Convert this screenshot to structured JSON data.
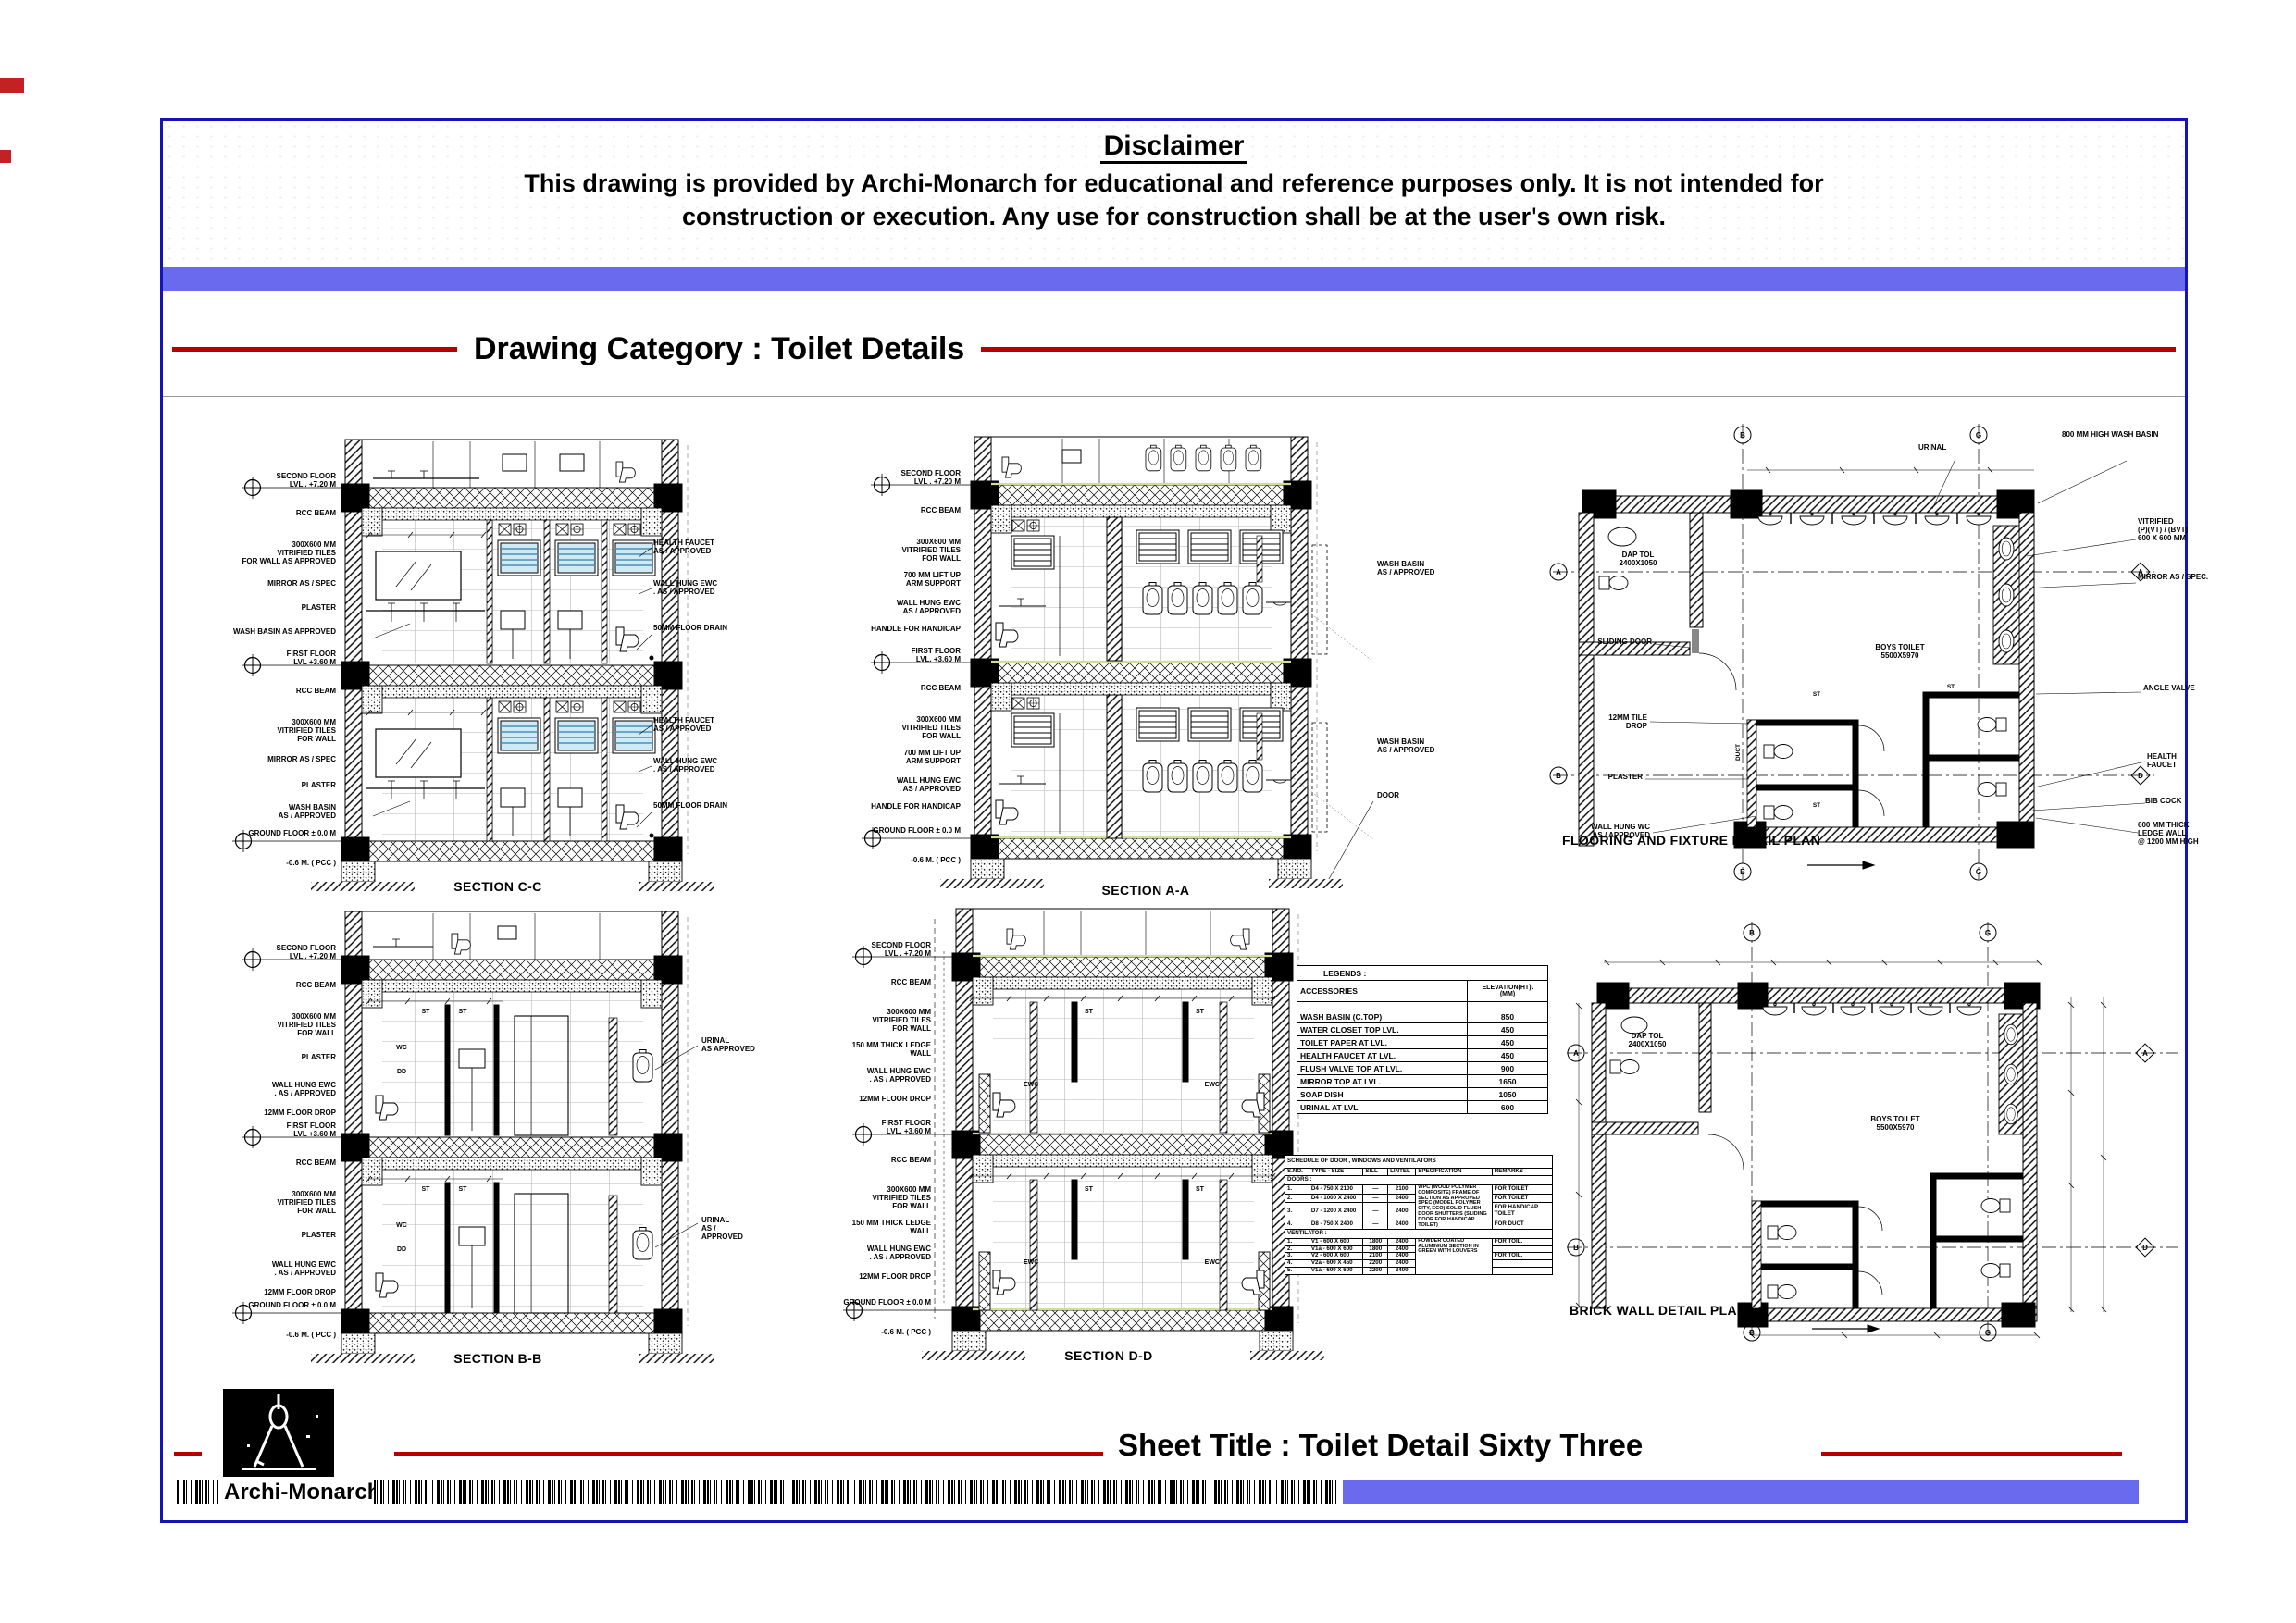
{
  "header": {
    "disclaimer_title": "Disclaimer",
    "disclaimer_line1": "This drawing is provided by Archi-Monarch for educational and reference purposes only. It is not intended for",
    "disclaimer_line2": "construction or execution. Any use for construction shall be at the user's own risk.",
    "category_label": "Drawing Category : Toilet Details"
  },
  "footer": {
    "sheet_title": "Sheet Title : Toilet Detail Sixty Three",
    "brand": "Archi-Monarch"
  },
  "colors": {
    "frame_blue": "#1414b8",
    "bar_blue": "#6a6aef",
    "accent_red": "#b40000",
    "louver_blue": "#cfe9f5"
  },
  "panels": {
    "section_cc": {
      "caption": "SECTION C-C",
      "labels_left": [
        "SECOND FLOOR\nLVL . +7.20 M",
        "RCC BEAM",
        "300X600 MM\nVITRIFIED TILES\nFOR WALL AS APPROVED",
        "MIRROR AS / SPEC",
        "PLASTER",
        "WASH BASIN AS APPROVED",
        "FIRST FLOOR\nLVL +3.60 M",
        "RCC BEAM",
        "300X600 MM\nVITRIFIED TILES\nFOR WALL",
        "MIRROR AS / SPEC",
        "PLASTER",
        "WASH BASIN\nAS / APPROVED",
        "GROUND FLOOR ± 0.0 M",
        "-0.6 M. ( PCC )"
      ],
      "labels_right": [
        "HEALTH FAUCET\nAS / APPROVED",
        "WALL HUNG EWC\n. AS / APPROVED",
        "50MM FLOOR DRAIN",
        "HEALTH FAUCET\nAS / APPROVED",
        "WALL HUNG EWC\n. AS / APPROVED",
        "50MM FLOOR DRAIN"
      ]
    },
    "section_aa": {
      "caption": "SECTION A-A",
      "labels_left": [
        "SECOND FLOOR\nLVL . +7.20 M",
        "RCC BEAM",
        "300X600 MM\nVITRIFIED TILES\nFOR WALL",
        "700 MM LIFT UP\nARM SUPPORT",
        "WALL HUNG EWC\n. AS / APPROVED",
        "HANDLE FOR HANDICAP",
        "FIRST FLOOR\nLVL. +3.60 M",
        "RCC BEAM",
        "300X600 MM\nVITRIFIED TILES\nFOR WALL",
        "700 MM LIFT UP\nARM SUPPORT",
        "WALL HUNG EWC\n. AS / APPROVED",
        "HANDLE FOR HANDICAP",
        "GROUND FLOOR ± 0.0 M",
        "-0.6 M. ( PCC )"
      ],
      "labels_right": [
        "WASH BASIN\nAS / APPROVED",
        "WASH BASIN\nAS / APPROVED",
        "DOOR"
      ]
    },
    "plan_flooring": {
      "caption": "FLOORING AND FIXTURE DETAIL PLAN",
      "room_boys": "BOYS TOILET\n5500X5970",
      "room_dap": "DAP TOL\n2400X1050",
      "room_duct": "DUCT",
      "label_urinal": "URINAL",
      "labels_right": [
        "800 MM HIGH WASH BASIN",
        "VITRIFIED\n(P)(VT) / (BVT)\n600 X 600 MM",
        "MIRROR AS / SPEC.",
        "ANGLE VALVE",
        "HEALTH\nFAUCET",
        "BIB COCK",
        "600 MM THICK\nLEDGE WALL\n@ 1200 MM HIGH"
      ],
      "labels_left": [
        "SLIDING DOOR",
        "12MM TILE\nDROP",
        "PLASTER",
        "WALL HUNG WC\nAS / APPROVED"
      ],
      "grid": [
        "B",
        "G",
        "A",
        "B",
        "A",
        "D",
        "B",
        "G"
      ],
      "marks": [
        "ST",
        "ST",
        "ST"
      ]
    },
    "section_bb": {
      "caption": "SECTION B-B",
      "labels_left": [
        "SECOND FLOOR\nLVL . +7.20 M",
        "RCC BEAM",
        "300X600 MM\nVITRIFIED TILES\nFOR WALL",
        "PLASTER",
        "WALL HUNG EWC\n. AS / APPROVED",
        "12MM FLOOR DROP",
        "FIRST FLOOR\nLVL +3.60 M",
        "RCC BEAM",
        "300X600 MM\nVITRIFIED TILES\nFOR WALL",
        "PLASTER",
        "WALL HUNG EWC\n. AS / APPROVED",
        "12MM FLOOR DROP",
        "GROUND FLOOR ± 0.0 M",
        "-0.6 M. ( PCC )"
      ],
      "labels_right": [
        "URINAL\nAS APPROVED",
        "URINAL\nAS / APPROVED"
      ],
      "marks": [
        "ST",
        "ST",
        "WC",
        "DD",
        "ST",
        "ST",
        "WC",
        "DD"
      ]
    },
    "section_dd": {
      "caption": "SECTION D-D",
      "labels_left": [
        "SECOND FLOOR\nLVL . +7.20 M",
        "RCC BEAM",
        "300X600 MM\nVITRIFIED TILES\nFOR WALL",
        "150 MM THICK LEDGE WALL",
        "WALL HUNG EWC\n. AS / APPROVED",
        "12MM FLOOR DROP",
        "FIRST FLOOR\nLVL. +3.60 M",
        "RCC BEAM",
        "300X600 MM\nVITRIFIED TILES\nFOR WALL",
        "150 MM THICK LEDGE WALL",
        "WALL HUNG EWC\n. AS / APPROVED",
        "12MM FLOOR DROP",
        "GROUND FLOOR ± 0.0 M",
        "-0.6 M. ( PCC )"
      ],
      "marks": [
        "ST",
        "ST",
        "EWC",
        "EWC",
        "ST",
        "ST",
        "EWC",
        "EWC"
      ]
    },
    "plan_brick": {
      "caption": "BRICK WALL DETAIL PLAN",
      "room_boys": "BOYS TOILET\n5500X5970",
      "room_dap": "DAP TOL\n2400X1050",
      "grid": [
        "B",
        "G",
        "A",
        "B",
        "A",
        "D",
        "B",
        "G"
      ]
    }
  },
  "legends": {
    "title": "LEGENDS :",
    "col_accessories": "ACCESSORIES",
    "col_elevation": "ELEVATION(HT).\n(MM)",
    "rows": [
      [
        "WASH BASIN (C.TOP)",
        "850"
      ],
      [
        "WATER CLOSET TOP LVL.",
        "450"
      ],
      [
        "TOILET PAPER  AT LVL.",
        "450"
      ],
      [
        "HEALTH FAUCET AT LVL.",
        "450"
      ],
      [
        "FLUSH VALVE  TOP AT LVL.",
        "900"
      ],
      [
        "MIRROR TOP  AT LVL.",
        "1650"
      ],
      [
        "SOAP DISH",
        "1050"
      ],
      [
        "URINAL AT LVL",
        "600"
      ]
    ]
  },
  "schedule": {
    "title": "SCHEDULE OF DOOR , WINDOWS AND VENTILATORS",
    "headers": [
      "S.NO.",
      "TYPE - SIZE",
      "SILL",
      "LINTEL",
      "SPECIFICATION",
      "REMARKS"
    ],
    "doors_heading": "DOORS :",
    "doors_spec": "WPC (WOOD POLYMER COMPOSITE) FRAME OF SECTION AS APPROVED SPEC (MODEL POLYMER CITY, ECO) SOLID FLUSH DOOR SHUTTERS (SLIDING DOOR FOR HANDICAP TOILET)",
    "doors": [
      [
        "1.",
        "D4 - 750 X 2100",
        "—",
        "2100",
        "FOR TOILET"
      ],
      [
        "2.",
        "D4 - 1000 X 2400",
        "—",
        "2400",
        "FOR TOILET"
      ],
      [
        "3.",
        "D7 - 1200 X 2400",
        "—",
        "2400",
        "FOR HANDICAP TOILET"
      ],
      [
        "4.",
        "D8 - 750 X 2400",
        "—",
        "2400",
        "FOR DUCT"
      ]
    ],
    "vent_heading": "VENTILATOR :",
    "vent_spec": "POWDER COATED ALUMINIUM SECTION IN GREEN WITH LOUVERS",
    "vents": [
      [
        "1.",
        "V1 - 600 X 600",
        "1800",
        "2400",
        "FOR TOIL."
      ],
      [
        "2.",
        "V1a - 600 X 600",
        "1800",
        "2400",
        ""
      ],
      [
        "3.",
        "V2 - 600 X 600",
        "2100",
        "2400",
        "FOR TOIL."
      ],
      [
        "4.",
        "V2a - 600 X 450",
        "2200",
        "2400",
        ""
      ],
      [
        "5.",
        "V1a - 600 X 600",
        "2200",
        "2400",
        ""
      ]
    ]
  }
}
